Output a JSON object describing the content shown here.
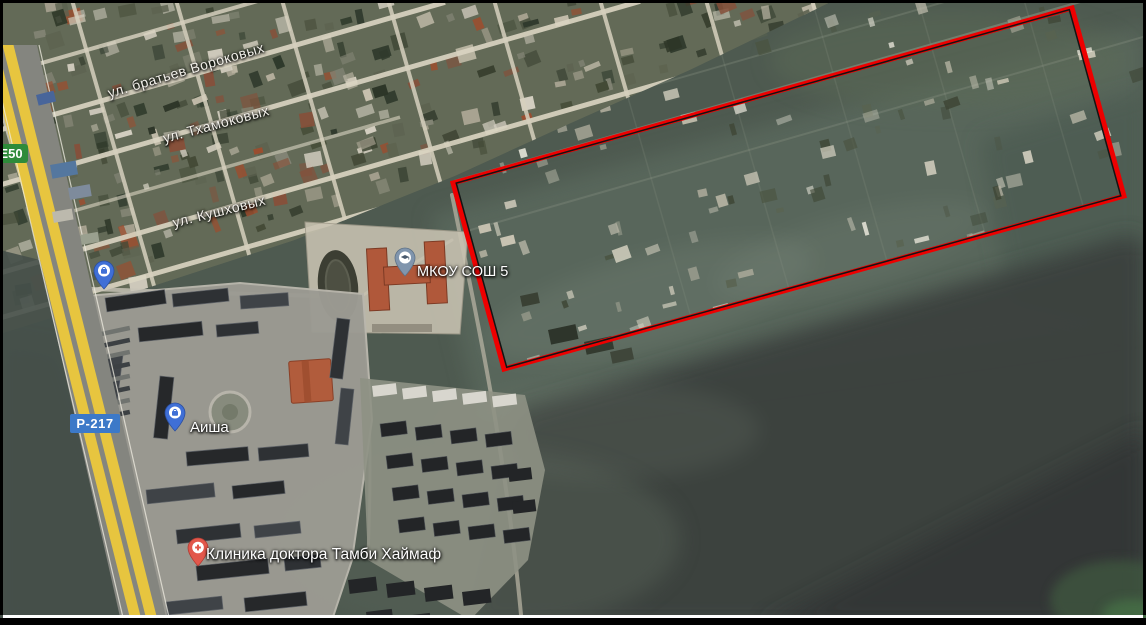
{
  "map": {
    "type": "satellite-view",
    "street_labels": [
      {
        "id": "vorokovyh",
        "text": "ул. братьев Вороковых"
      },
      {
        "id": "thamokovyh",
        "text": "ул. Тхамоковых"
      },
      {
        "id": "kushhovyh",
        "text": "ул. Кушховых"
      }
    ],
    "route_badges": [
      {
        "id": "e50",
        "text": "E50",
        "color": "#2e8b3a"
      },
      {
        "id": "r217",
        "text": "Р-217",
        "color": "#3c79c8"
      }
    ],
    "poi": [
      {
        "id": "school",
        "text": "МКОУ СОШ 5",
        "pin": "school-pin",
        "pin_color": "#8095ad"
      },
      {
        "id": "aisha",
        "text": "Аиша",
        "pin": "shopping-pin",
        "pin_color": "#3f6fd6"
      },
      {
        "id": "clinic",
        "text": "Клиника доктора Тамби Хаймаф",
        "pin": "hospital-pin",
        "pin_color": "#e2574b"
      },
      {
        "id": "shop-unlabeled",
        "text": "",
        "pin": "shopping-pin",
        "pin_color": "#3f6fd6"
      }
    ],
    "annotation": {
      "shape": "quadrilateral",
      "stroke_color": "#ee0000",
      "inner_line_color": "#141414",
      "points": [
        [
          453,
          183
        ],
        [
          1072,
          8
        ],
        [
          1124,
          196
        ],
        [
          504,
          369
        ]
      ]
    },
    "colors": {
      "field_base": "#4e5a50",
      "field_dark": "#343a39",
      "residential_base": "#636a57",
      "street": "#dbd5c3",
      "highway_yellow": "#e7c53f",
      "complex_ground": "#9c9b93",
      "building_dark": "#26282a",
      "school_roof": "#b0583a"
    }
  }
}
